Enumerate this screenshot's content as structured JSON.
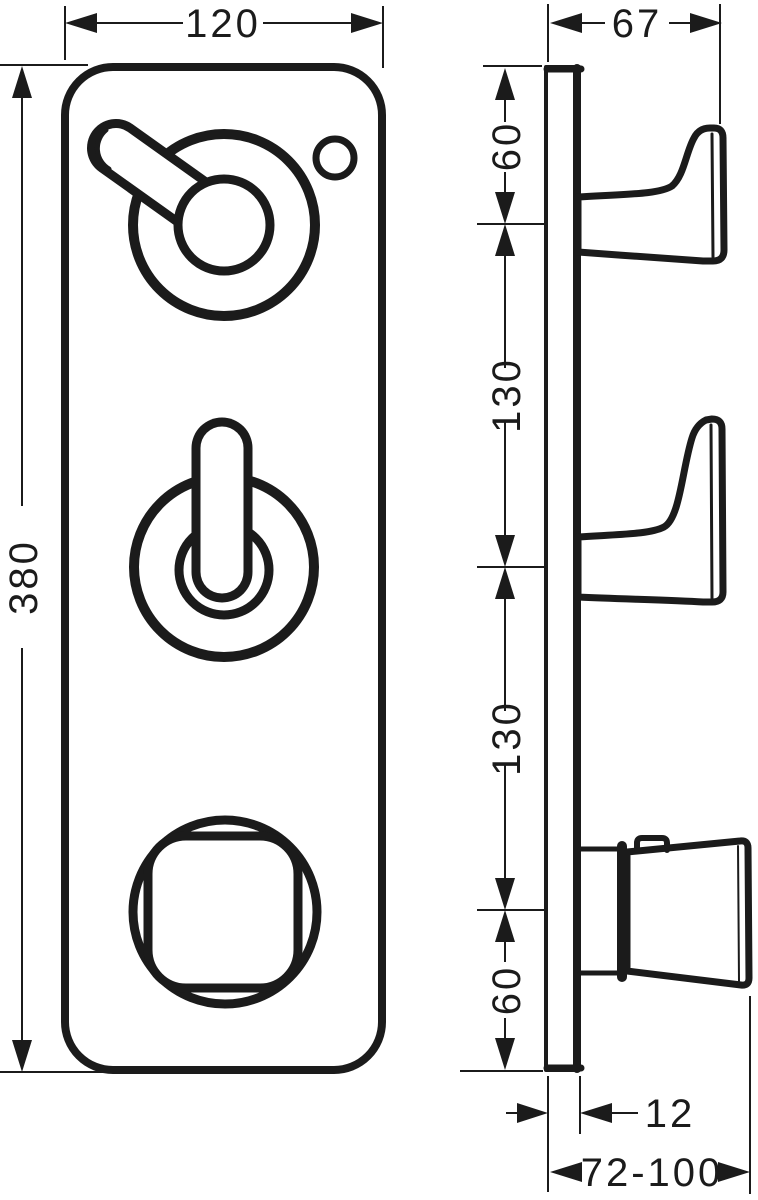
{
  "drawing": {
    "type": "technical-dimension-drawing",
    "subject": "concealed 3-function thermostatic shower module, front view and side view"
  },
  "dimensions": {
    "front_width": "120",
    "front_height": "380",
    "side_depth": "67",
    "seg_top": "60",
    "seg_upper": "130",
    "seg_lower": "130",
    "seg_bottom": "60",
    "plate_thickness": "12",
    "projection_range": "72-100"
  },
  "colors": {
    "line": "#1b1b1b",
    "background": "#ffffff"
  }
}
